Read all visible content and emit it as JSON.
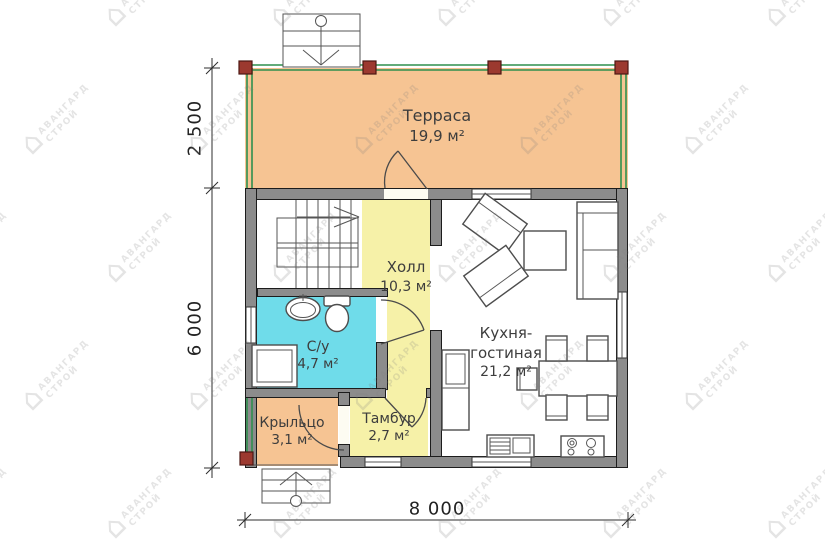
{
  "watermark": {
    "house_glyph": "⌂",
    "brand_line1": "АВАНГАРД",
    "brand_line2": "СТРОЙ"
  },
  "rooms": {
    "terrace": {
      "name": "Терраса",
      "area": "19,9 м²"
    },
    "hall": {
      "name": "Холл",
      "area": "10,3 м²"
    },
    "bathroom": {
      "name": "С/у",
      "area": "4,7 м²"
    },
    "kitchen": {
      "name_line1": "Кухня-",
      "name_line2": "гостиная",
      "area": "21,2 м²"
    },
    "porch": {
      "name": "Крыльцо",
      "area": "3,1 м²"
    },
    "vestibule": {
      "name": "Тамбур",
      "area": "2,7 м²"
    }
  },
  "dimensions": {
    "terrace_depth": "2 500",
    "house_depth": "6 000",
    "total_width": "8 000"
  },
  "colors": {
    "terrace_fill": "#f6c493",
    "porch_fill": "#f6c493",
    "hall_fill": "#f6f1a8",
    "vestibule_fill": "#f6f1a8",
    "bathroom_fill": "#6fdcea",
    "wall": "#8c8c8c",
    "railing": "#2f8f4e",
    "post": "#9c392f"
  }
}
